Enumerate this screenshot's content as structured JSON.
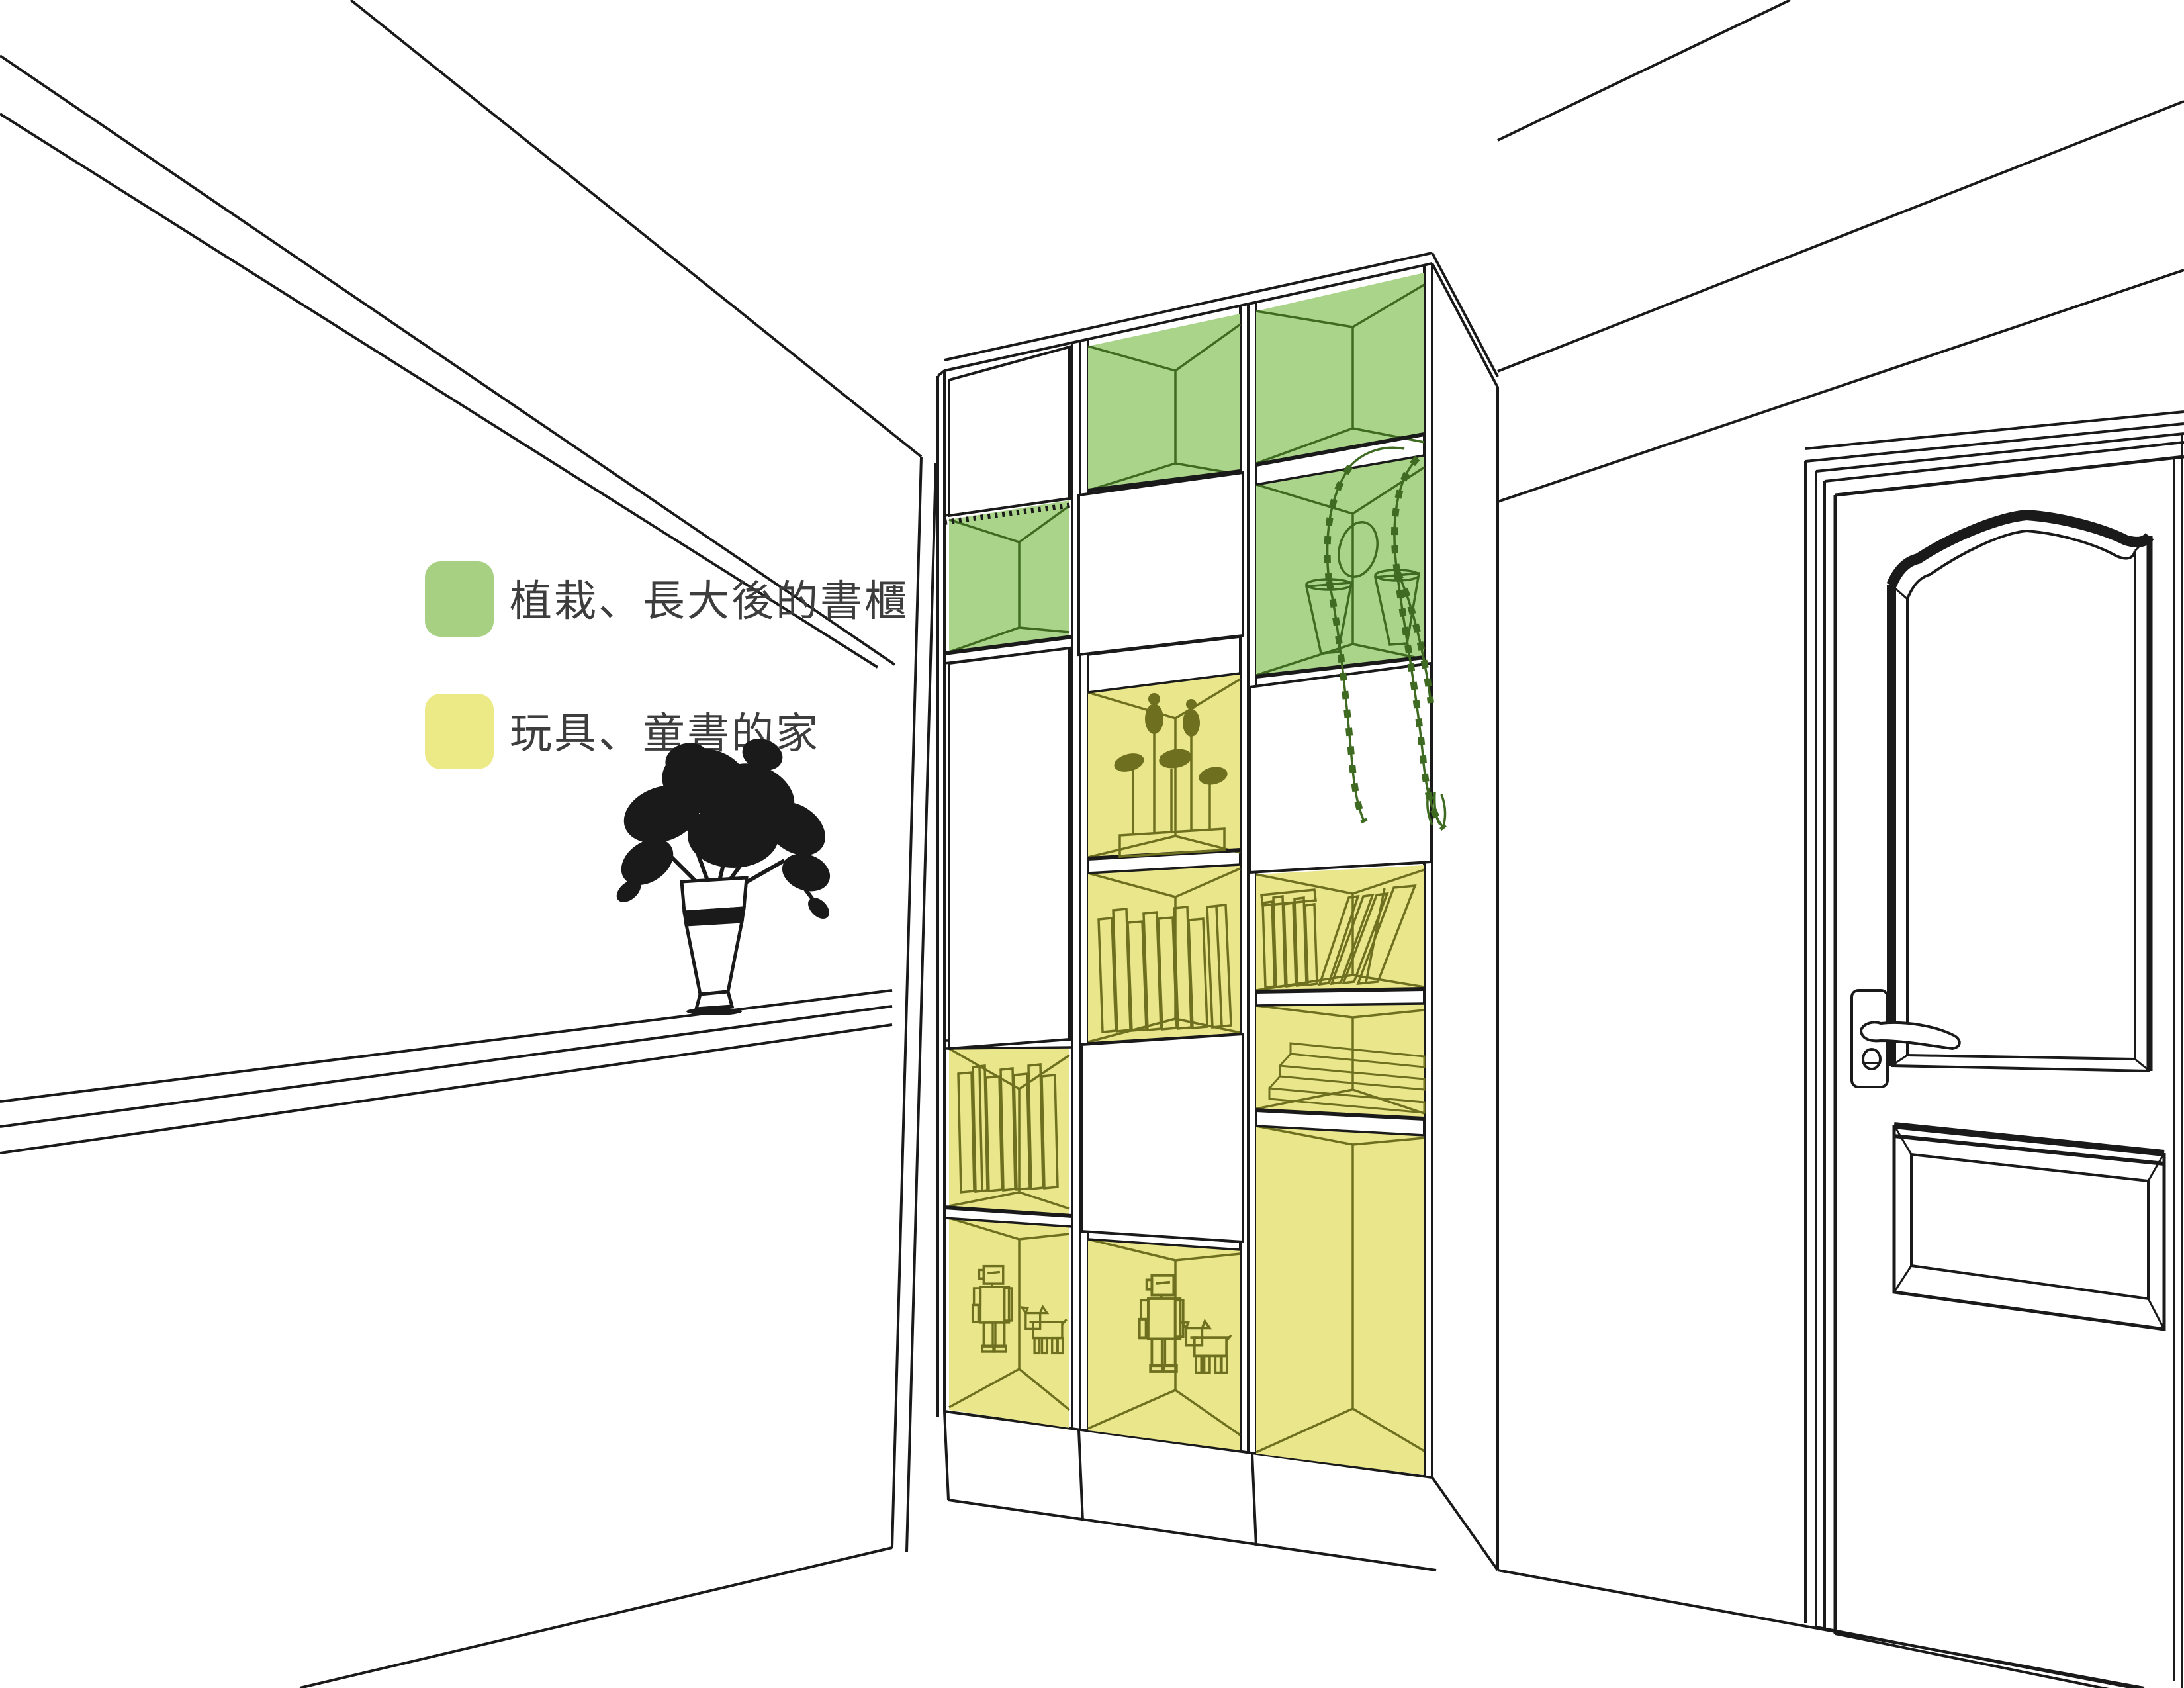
{
  "legend": {
    "items": [
      {
        "id": "green",
        "label": "植栽、長大後的書櫃",
        "color": "#a7d083"
      },
      {
        "id": "yellow",
        "label": "玩具、童書的家",
        "color": "#ece987"
      }
    ]
  },
  "colors": {
    "background": "#ffffff",
    "ink": "#1a1a1a",
    "text": "#3d3d3d",
    "green_fill": "#aad489",
    "green_line": "#3e6b21",
    "yellow_fill": "#e9e68b",
    "olive_line": "#6e7020"
  },
  "bookshelf": {
    "columns": 3,
    "cells": [
      {
        "column": "left",
        "row": 1,
        "kind": "closed-door"
      },
      {
        "column": "left",
        "row": 2,
        "kind": "open",
        "color": "green",
        "content": "empty"
      },
      {
        "column": "left",
        "row": 3,
        "kind": "closed-door-tall"
      },
      {
        "column": "left",
        "row": 4,
        "kind": "open",
        "color": "yellow",
        "content": "books"
      },
      {
        "column": "left",
        "row": 5,
        "kind": "open",
        "color": "yellow",
        "content": "robot-toys"
      },
      {
        "column": "middle",
        "row": 1,
        "kind": "open",
        "color": "green",
        "content": "empty"
      },
      {
        "column": "middle",
        "row": 2,
        "kind": "closed-door"
      },
      {
        "column": "middle",
        "row": 3,
        "kind": "open",
        "color": "yellow",
        "content": "bird-sculptures"
      },
      {
        "column": "middle",
        "row": 4,
        "kind": "open",
        "color": "yellow",
        "content": "books"
      },
      {
        "column": "middle",
        "row": 5,
        "kind": "closed-door"
      },
      {
        "column": "middle",
        "row": 6,
        "kind": "open",
        "color": "yellow",
        "content": "robot-toys"
      },
      {
        "column": "right",
        "row": 1,
        "kind": "open",
        "color": "green",
        "content": "empty"
      },
      {
        "column": "right",
        "row": 2,
        "kind": "open",
        "color": "green",
        "content": "hanging-plant"
      },
      {
        "column": "right",
        "row": 3,
        "kind": "closed-door"
      },
      {
        "column": "right",
        "row": 4,
        "kind": "open",
        "color": "yellow",
        "content": "books"
      },
      {
        "column": "right",
        "row": 5,
        "kind": "open",
        "color": "yellow",
        "content": "stepped-display"
      },
      {
        "column": "right",
        "row": 6,
        "kind": "open",
        "color": "yellow",
        "content": "empty"
      }
    ]
  },
  "door": {
    "panels": [
      "arched-top-panel",
      "rectangular-bottom-panel"
    ],
    "hardware": [
      "lever-handle",
      "keyhole"
    ]
  },
  "decor": {
    "vase_plant": "black-silhouette-plant-in-vase",
    "ledge": "chair-rail"
  }
}
